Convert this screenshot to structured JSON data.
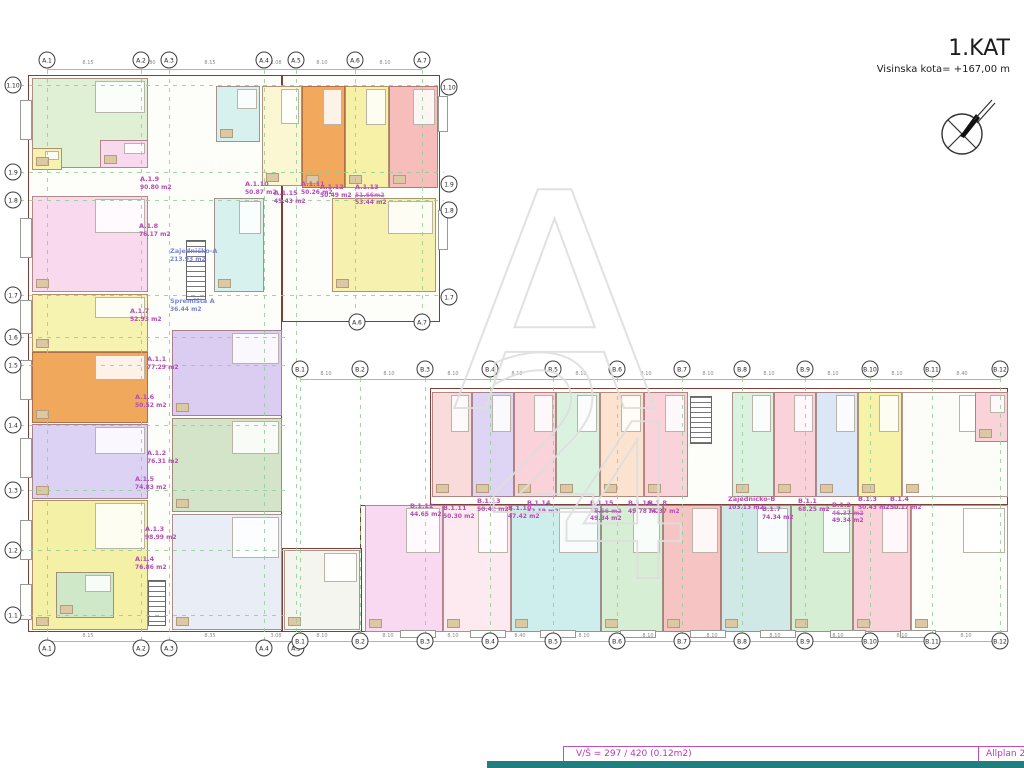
{
  "title": {
    "floor": "1.KAT",
    "kota": "Visinska kota= +167,00 m"
  },
  "statusbar": {
    "left": "V/Š = 297 / 420 (0.12m2)",
    "right": "Allplan 2",
    "accent": "#b53ab5",
    "teal": "#217e7e"
  },
  "colors": {
    "label": "#b44cb4",
    "common_label": "#7b86cf",
    "grid": "#8fcf96",
    "wall": "#7d4038"
  },
  "axes": {
    "a_top": [
      {
        "label": "A.1",
        "x": 47
      },
      {
        "label": "A.2",
        "x": 141
      },
      {
        "label": "A.3",
        "x": 169
      },
      {
        "label": "A.4",
        "x": 264
      },
      {
        "label": "A.5",
        "x": 296
      },
      {
        "label": "A.6",
        "x": 355
      },
      {
        "label": "A.7",
        "x": 422
      }
    ],
    "a_mid": [
      {
        "label": "A.6",
        "x": 357
      },
      {
        "label": "A.7",
        "x": 422
      }
    ],
    "a_bottom": [
      {
        "label": "A.1",
        "x": 47
      },
      {
        "label": "A.2",
        "x": 141
      },
      {
        "label": "A.3",
        "x": 169
      },
      {
        "label": "A.4",
        "x": 264
      },
      {
        "label": "A.5",
        "x": 296
      }
    ],
    "b_top": [
      {
        "label": "B.1",
        "x": 300
      },
      {
        "label": "B.2",
        "x": 360
      },
      {
        "label": "B.3",
        "x": 425
      },
      {
        "label": "B.4",
        "x": 490
      },
      {
        "label": "B.5",
        "x": 553
      },
      {
        "label": "B.6",
        "x": 617
      },
      {
        "label": "B.7",
        "x": 682
      },
      {
        "label": "B.8",
        "x": 742
      },
      {
        "label": "B.9",
        "x": 805
      },
      {
        "label": "B.10",
        "x": 870
      },
      {
        "label": "B.11",
        "x": 932
      },
      {
        "label": "B.12",
        "x": 1000
      }
    ],
    "b_bottom": [
      {
        "label": "B.1",
        "x": 300
      },
      {
        "label": "B.2",
        "x": 360
      },
      {
        "label": "B.3",
        "x": 425
      },
      {
        "label": "B.4",
        "x": 490
      },
      {
        "label": "B.5",
        "x": 553
      },
      {
        "label": "B.6",
        "x": 617
      },
      {
        "label": "B.7",
        "x": 682
      },
      {
        "label": "B.8",
        "x": 742
      },
      {
        "label": "B.9",
        "x": 805
      },
      {
        "label": "B.10",
        "x": 870
      },
      {
        "label": "B.11",
        "x": 932
      },
      {
        "label": "B.12",
        "x": 1000
      }
    ],
    "rows_left": [
      {
        "label": "1.10",
        "y": 85
      },
      {
        "label": "1.9",
        "y": 172
      },
      {
        "label": "1.8",
        "y": 200
      },
      {
        "label": "1.7",
        "y": 295
      },
      {
        "label": "1.6",
        "y": 337
      },
      {
        "label": "1.5",
        "y": 365
      },
      {
        "label": "1.4",
        "y": 425
      },
      {
        "label": "1.3",
        "y": 490
      },
      {
        "label": "1.2",
        "y": 550
      },
      {
        "label": "1.1",
        "y": 615
      }
    ],
    "rows_right": [
      {
        "label": "1.10",
        "y": 87
      },
      {
        "label": "1.9",
        "y": 184
      },
      {
        "label": "1.8",
        "y": 210
      },
      {
        "label": "1.7",
        "y": 297
      }
    ]
  },
  "dims": {
    "top": [
      {
        "v": "8.15",
        "x": 88
      },
      {
        "v": "2.80",
        "x": 150
      },
      {
        "v": "8.15",
        "x": 210
      },
      {
        "v": "3.08",
        "x": 276
      },
      {
        "v": "8.10",
        "x": 322
      },
      {
        "v": "8.10",
        "x": 385
      }
    ],
    "b_row": [
      {
        "v": "8.10",
        "x": 326
      },
      {
        "v": "8.10",
        "x": 389
      },
      {
        "v": "8.10",
        "x": 453
      },
      {
        "v": "8.10",
        "x": 517
      },
      {
        "v": "8.10",
        "x": 581
      },
      {
        "v": "8.10",
        "x": 646
      },
      {
        "v": "8.10",
        "x": 708
      },
      {
        "v": "8.10",
        "x": 769
      },
      {
        "v": "8.10",
        "x": 833
      },
      {
        "v": "8.10",
        "x": 897
      },
      {
        "v": "8.40",
        "x": 962
      }
    ],
    "bottom": [
      {
        "v": "8.15",
        "x": 88
      },
      {
        "v": "8.35",
        "x": 210
      },
      {
        "v": "3.08",
        "x": 276
      },
      {
        "v": "8.10",
        "x": 322
      },
      {
        "v": "8.10",
        "x": 388
      },
      {
        "v": "8.10",
        "x": 453
      },
      {
        "v": "8.40",
        "x": 520
      },
      {
        "v": "8.10",
        "x": 584
      },
      {
        "v": "8.10",
        "x": 648
      },
      {
        "v": "8.10",
        "x": 712
      },
      {
        "v": "8.10",
        "x": 775
      },
      {
        "v": "8.10",
        "x": 838
      },
      {
        "v": "8.10",
        "x": 902
      },
      {
        "v": "8.10",
        "x": 966
      }
    ]
  },
  "grid": {
    "vlines": [
      {
        "x": 47,
        "y": 70,
        "w": 1,
        "h": 582
      },
      {
        "x": 141,
        "y": 70,
        "w": 1,
        "h": 582
      },
      {
        "x": 169,
        "y": 70,
        "w": 1,
        "h": 582
      },
      {
        "x": 264,
        "y": 70,
        "w": 1,
        "h": 582
      },
      {
        "x": 296,
        "y": 70,
        "w": 1,
        "h": 582
      },
      {
        "x": 355,
        "y": 70,
        "w": 1,
        "h": 246
      },
      {
        "x": 422,
        "y": 70,
        "w": 1,
        "h": 246
      },
      {
        "x": 300,
        "y": 378,
        "w": 1,
        "h": 258
      },
      {
        "x": 360,
        "y": 378,
        "w": 1,
        "h": 258
      },
      {
        "x": 425,
        "y": 378,
        "w": 1,
        "h": 258
      },
      {
        "x": 490,
        "y": 378,
        "w": 1,
        "h": 258
      },
      {
        "x": 553,
        "y": 378,
        "w": 1,
        "h": 258
      },
      {
        "x": 617,
        "y": 378,
        "w": 1,
        "h": 258
      },
      {
        "x": 682,
        "y": 378,
        "w": 1,
        "h": 258
      },
      {
        "x": 742,
        "y": 378,
        "w": 1,
        "h": 258
      },
      {
        "x": 805,
        "y": 378,
        "w": 1,
        "h": 258
      },
      {
        "x": 870,
        "y": 378,
        "w": 1,
        "h": 258
      },
      {
        "x": 932,
        "y": 378,
        "w": 1,
        "h": 258
      },
      {
        "x": 1000,
        "y": 378,
        "w": 1,
        "h": 258
      }
    ],
    "hlines": [
      {
        "x": 20,
        "y": 85,
        "w": 424,
        "h": 1
      },
      {
        "x": 20,
        "y": 172,
        "w": 424,
        "h": 1
      },
      {
        "x": 20,
        "y": 200,
        "w": 424,
        "h": 1
      },
      {
        "x": 20,
        "y": 295,
        "w": 424,
        "h": 1
      },
      {
        "x": 20,
        "y": 337,
        "w": 268,
        "h": 1
      },
      {
        "x": 20,
        "y": 365,
        "w": 268,
        "h": 1
      },
      {
        "x": 20,
        "y": 425,
        "w": 268,
        "h": 1
      },
      {
        "x": 20,
        "y": 490,
        "w": 268,
        "h": 1
      },
      {
        "x": 20,
        "y": 550,
        "w": 268,
        "h": 1
      },
      {
        "x": 20,
        "y": 615,
        "w": 268,
        "h": 1
      }
    ]
  },
  "units": [
    {
      "x": 32,
      "y": 78,
      "w": 116,
      "h": 90,
      "bg": "#dff0d5"
    },
    {
      "x": 100,
      "y": 140,
      "w": 48,
      "h": 28,
      "bg": "#f9d9ee"
    },
    {
      "x": 32,
      "y": 148,
      "w": 30,
      "h": 22,
      "bg": "#f6f2b0"
    },
    {
      "x": 32,
      "y": 196,
      "w": 116,
      "h": 96,
      "bg": "#f9d9ee"
    },
    {
      "x": 32,
      "y": 294,
      "w": 116,
      "h": 58,
      "bg": "#f6f2b0"
    },
    {
      "x": 32,
      "y": 352,
      "w": 116,
      "h": 71,
      "bg": "#f0a95c"
    },
    {
      "x": 32,
      "y": 424,
      "w": 116,
      "h": 75,
      "bg": "#dcd2f4"
    },
    {
      "x": 32,
      "y": 500,
      "w": 116,
      "h": 130,
      "bg": "#f4f0a6"
    },
    {
      "x": 56,
      "y": 572,
      "w": 58,
      "h": 46,
      "bg": "#cfe8c8"
    },
    {
      "x": 172,
      "y": 330,
      "w": 110,
      "h": 86,
      "bg": "#dbccf2"
    },
    {
      "x": 172,
      "y": 418,
      "w": 110,
      "h": 94,
      "bg": "#d4e4c9"
    },
    {
      "x": 172,
      "y": 514,
      "w": 110,
      "h": 116,
      "bg": "#e9edf6"
    },
    {
      "x": 216,
      "y": 86,
      "w": 44,
      "h": 56,
      "bg": "#d7f1ee"
    },
    {
      "x": 214,
      "y": 198,
      "w": 50,
      "h": 94,
      "bg": "#d7f1ee"
    },
    {
      "x": 262,
      "y": 86,
      "w": 40,
      "h": 100,
      "bg": "#fbf7d2"
    },
    {
      "x": 302,
      "y": 86,
      "w": 43,
      "h": 102,
      "bg": "#f2a95e"
    },
    {
      "x": 345,
      "y": 86,
      "w": 44,
      "h": 102,
      "bg": "#f6f1a6"
    },
    {
      "x": 389,
      "y": 86,
      "w": 49,
      "h": 102,
      "bg": "#f6bdbb"
    },
    {
      "x": 332,
      "y": 198,
      "w": 104,
      "h": 94,
      "bg": "#f6f1ae"
    },
    {
      "x": 432,
      "y": 392,
      "w": 40,
      "h": 105,
      "bg": "#f9dbdc"
    },
    {
      "x": 472,
      "y": 392,
      "w": 42,
      "h": 105,
      "bg": "#ded5f5"
    },
    {
      "x": 514,
      "y": 392,
      "w": 42,
      "h": 105,
      "bg": "#f9d2da"
    },
    {
      "x": 556,
      "y": 392,
      "w": 44,
      "h": 105,
      "bg": "#dcf2e0"
    },
    {
      "x": 600,
      "y": 392,
      "w": 44,
      "h": 105,
      "bg": "#fbe3cf"
    },
    {
      "x": 644,
      "y": 392,
      "w": 44,
      "h": 105,
      "bg": "#f9d2da"
    },
    {
      "x": 732,
      "y": 392,
      "w": 42,
      "h": 105,
      "bg": "#dcf2e0"
    },
    {
      "x": 774,
      "y": 392,
      "w": 42,
      "h": 105,
      "bg": "#f9d2da"
    },
    {
      "x": 816,
      "y": 392,
      "w": 42,
      "h": 105,
      "bg": "#dbe7f7"
    },
    {
      "x": 858,
      "y": 392,
      "w": 44,
      "h": 105,
      "bg": "#f6f2a8"
    },
    {
      "x": 902,
      "y": 392,
      "w": 106,
      "h": 105,
      "bg": "#fcfcf8"
    },
    {
      "x": 975,
      "y": 392,
      "w": 33,
      "h": 50,
      "bg": "#f9d2da"
    },
    {
      "x": 365,
      "y": 505,
      "w": 78,
      "h": 127,
      "bg": "#f9d9f2"
    },
    {
      "x": 443,
      "y": 505,
      "w": 68,
      "h": 127,
      "bg": "#fdeaf0"
    },
    {
      "x": 511,
      "y": 505,
      "w": 90,
      "h": 127,
      "bg": "#cdeeec"
    },
    {
      "x": 601,
      "y": 505,
      "w": 62,
      "h": 127,
      "bg": "#d6eed3"
    },
    {
      "x": 663,
      "y": 505,
      "w": 58,
      "h": 127,
      "bg": "#f6c5c3"
    },
    {
      "x": 721,
      "y": 505,
      "w": 70,
      "h": 127,
      "bg": "#d0e9e6"
    },
    {
      "x": 791,
      "y": 505,
      "w": 62,
      "h": 127,
      "bg": "#d6eed3"
    },
    {
      "x": 853,
      "y": 505,
      "w": 58,
      "h": 127,
      "bg": "#f9d2da"
    },
    {
      "x": 911,
      "y": 505,
      "w": 97,
      "h": 127,
      "bg": "#fdfdf9"
    },
    {
      "x": 284,
      "y": 550,
      "w": 76,
      "h": 80,
      "bg": "#f3f5ee"
    }
  ],
  "balconies": [
    {
      "x": 20,
      "y": 100,
      "w": 12,
      "h": 40
    },
    {
      "x": 20,
      "y": 218,
      "w": 12,
      "h": 40
    },
    {
      "x": 20,
      "y": 300,
      "w": 12,
      "h": 34
    },
    {
      "x": 20,
      "y": 360,
      "w": 12,
      "h": 40
    },
    {
      "x": 20,
      "y": 438,
      "w": 12,
      "h": 40
    },
    {
      "x": 20,
      "y": 520,
      "w": 12,
      "h": 40
    },
    {
      "x": 20,
      "y": 584,
      "w": 12,
      "h": 36
    },
    {
      "x": 438,
      "y": 96,
      "w": 10,
      "h": 36
    },
    {
      "x": 438,
      "y": 210,
      "w": 10,
      "h": 40
    },
    {
      "x": 400,
      "y": 630,
      "w": 36,
      "h": 8
    },
    {
      "x": 470,
      "y": 630,
      "w": 36,
      "h": 8
    },
    {
      "x": 540,
      "y": 630,
      "w": 36,
      "h": 8
    },
    {
      "x": 620,
      "y": 630,
      "w": 36,
      "h": 8
    },
    {
      "x": 690,
      "y": 630,
      "w": 36,
      "h": 8
    },
    {
      "x": 760,
      "y": 630,
      "w": 36,
      "h": 8
    },
    {
      "x": 830,
      "y": 630,
      "w": 36,
      "h": 8
    },
    {
      "x": 900,
      "y": 630,
      "w": 36,
      "h": 8
    }
  ],
  "apartments": [
    {
      "name": "A.1.9",
      "area": "90.80 m2",
      "x": 140,
      "y": 176
    },
    {
      "name": "A.1.10",
      "area": "50.87 m2",
      "x": 245,
      "y": 181
    },
    {
      "name": "A.1.11",
      "area": "50.26 m2",
      "x": 301,
      "y": 181
    },
    {
      "name": "A.1.15",
      "area": "45.43 m2",
      "x": 274,
      "y": 190
    },
    {
      "name": "A.1.12",
      "area": "50.49 m2",
      "x": 320,
      "y": 184
    },
    {
      "name": "A.1.13",
      "area": "53.44 m2",
      "struck": "51.66m2",
      "x": 355,
      "y": 184
    },
    {
      "name": "A.1.8",
      "area": "76.17 m2",
      "x": 139,
      "y": 223
    },
    {
      "name": "Zajedničko-A",
      "area": "213.93 m2",
      "x": 170,
      "y": 248,
      "c": "#7b86cf"
    },
    {
      "name": "Spremišta A",
      "area": "36.44 m2",
      "x": 170,
      "y": 298,
      "c": "#7b86cf"
    },
    {
      "name": "A.1.7",
      "area": "52.93 m2",
      "x": 130,
      "y": 308
    },
    {
      "name": "A.1.1",
      "area": "77.29 m2",
      "x": 147,
      "y": 356
    },
    {
      "name": "A.1.6",
      "area": "50.52 m2",
      "x": 135,
      "y": 394
    },
    {
      "name": "A.1.2",
      "area": "76.31 m2",
      "x": 147,
      "y": 450
    },
    {
      "name": "A.1.5",
      "area": "74.83 m2",
      "x": 135,
      "y": 476
    },
    {
      "name": "A.1.3",
      "area": "98.99 m2",
      "x": 145,
      "y": 526
    },
    {
      "name": "A.1.4",
      "area": "76.86 m2",
      "x": 135,
      "y": 556
    },
    {
      "name": "B.1.12",
      "area": "44.65 m2",
      "x": 410,
      "y": 503
    },
    {
      "name": "B.1.11",
      "area": "50.30 m2",
      "x": 443,
      "y": 505
    },
    {
      "name": "B.1.13",
      "area": "50.42 m2",
      "x": 477,
      "y": 498
    },
    {
      "name": "B.1.10",
      "area": "47.42 m2",
      "x": 508,
      "y": 505
    },
    {
      "name": "B.1.14",
      "area": "52.19 m2",
      "x": 527,
      "y": 500
    },
    {
      "name": "B.1.15",
      "area": "49.34 m2",
      "struck": "45.56 m2",
      "x": 590,
      "y": 500
    },
    {
      "name": "B.1.16",
      "area": "49.78 m2",
      "x": 628,
      "y": 500
    },
    {
      "name": "B.1.8",
      "area": "74.37 m2",
      "x": 648,
      "y": 500
    },
    {
      "name": "Zajedničko-B",
      "area": "103.13 m2",
      "x": 728,
      "y": 496,
      "c": "#b44cb4"
    },
    {
      "name": "B.1.7",
      "area": "74.34 m2",
      "x": 762,
      "y": 506
    },
    {
      "name": "B.1.1",
      "area": "68.25 m2",
      "x": 798,
      "y": 498
    },
    {
      "name": "B.1.2",
      "area": "49.34 m2",
      "struck": "46.37 m2",
      "x": 832,
      "y": 502
    },
    {
      "name": "B.1.3",
      "area": "50.43 m2",
      "x": 858,
      "y": 496
    },
    {
      "name": "B.1.4",
      "area": "50.17 m2",
      "x": 890,
      "y": 496
    }
  ],
  "watermark": {
    "letter": "A",
    "number": "24"
  }
}
